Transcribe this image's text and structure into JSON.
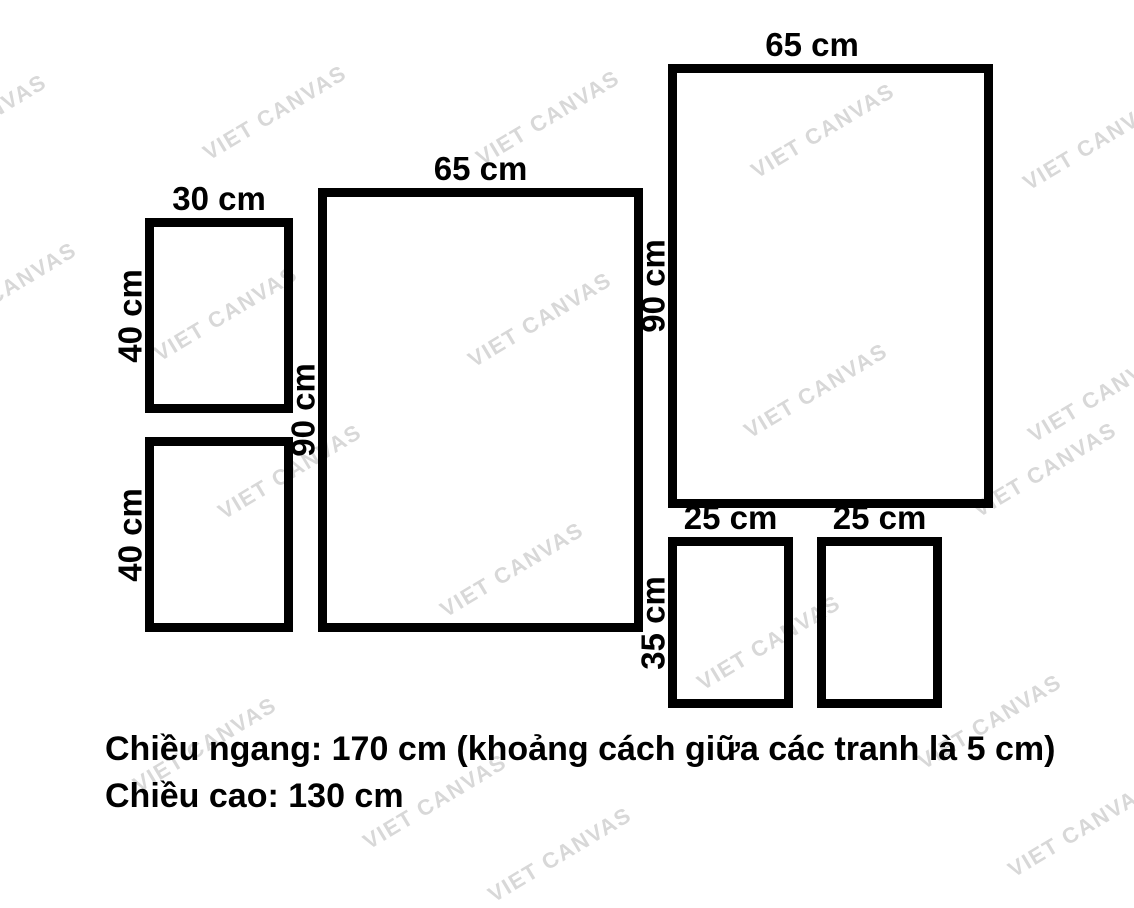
{
  "page": {
    "background_color": "#ffffff",
    "ink_color": "#000000",
    "watermark_color": "#d8d8d8"
  },
  "watermark": {
    "text": "VIET CANVAS",
    "positions": [
      [
        -25,
        122
      ],
      [
        275,
        113
      ],
      [
        548,
        118
      ],
      [
        823,
        131
      ],
      [
        1095,
        143
      ],
      [
        5,
        290
      ],
      [
        226,
        314
      ],
      [
        540,
        320
      ],
      [
        816,
        391
      ],
      [
        1100,
        395
      ],
      [
        290,
        472
      ],
      [
        1045,
        470
      ],
      [
        512,
        570
      ],
      [
        769,
        643
      ],
      [
        990,
        722
      ],
      [
        205,
        745
      ],
      [
        435,
        802
      ],
      [
        560,
        855
      ],
      [
        1080,
        830
      ]
    ]
  },
  "frames": [
    {
      "id": "frame-30x40-upper",
      "width_cm": 30,
      "height_cm": 40,
      "width_label": "30 cm",
      "height_label": "40 cm"
    },
    {
      "id": "frame-30x40-lower",
      "width_cm": 30,
      "height_cm": 40,
      "width_label": null,
      "height_label": "40 cm"
    },
    {
      "id": "frame-65x90-center",
      "width_cm": 65,
      "height_cm": 90,
      "width_label": "65 cm",
      "height_label": "90 cm"
    },
    {
      "id": "frame-65x90-right",
      "width_cm": 65,
      "height_cm": 90,
      "width_label": "65 cm",
      "height_label": "90 cm"
    },
    {
      "id": "frame-25x35-left",
      "width_cm": 25,
      "height_cm": 35,
      "width_label": "25 cm",
      "height_label": "35 cm"
    },
    {
      "id": "frame-25x35-right",
      "width_cm": 25,
      "height_cm": 35,
      "width_label": "25 cm",
      "height_label": null
    }
  ],
  "footer": {
    "line1": "Chiều ngang: 170 cm (khoảng cách giữa các tranh là 5 cm)",
    "line2": "Chiều cao: 130 cm"
  }
}
